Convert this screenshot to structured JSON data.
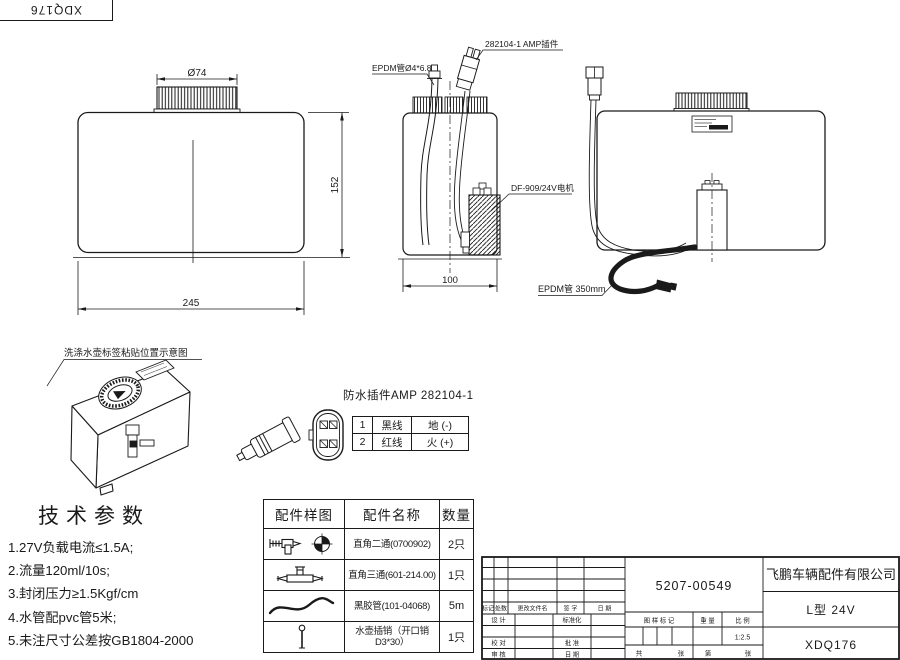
{
  "corner_stamp": {
    "code": "XDQ176"
  },
  "views": {
    "front": {
      "dims": {
        "cap_diameter": "Ø74",
        "height": "152",
        "width": "245"
      }
    },
    "side": {
      "dim_depth": "100",
      "callouts": {
        "tube": "EPDM管Ø4*6.8",
        "connector": "282104-1  AMP插件",
        "motor": "DF-909/24V电机"
      }
    },
    "right": {
      "callout_tube": "EPDM管 350mm"
    },
    "iso": {
      "caption": "洗涤水壶标签粘贴位置示意图"
    }
  },
  "connector_detail": {
    "title": "防水插件AMP 282104-1",
    "pins": [
      {
        "no": "1",
        "wire": "黑线",
        "function": "地 (-)"
      },
      {
        "no": "2",
        "wire": "红线",
        "function": "火 (+)"
      }
    ]
  },
  "tech_params": {
    "title": "技术参数",
    "items": [
      "1.27V负载电流≤1.5A;",
      "2.流量120ml/10s;",
      "3.封闭压力≥1.5Kgf/cm",
      "4.水管配pvc管5米;",
      "5.未注尺寸公差按GB1804-2000"
    ]
  },
  "parts_table": {
    "headers": [
      "配件样图",
      "配件名称",
      "数量"
    ],
    "rows": [
      {
        "icon": "elbow-fitting",
        "name": "直角二通(0700902)",
        "qty": "2只"
      },
      {
        "icon": "tee-fitting",
        "name": "直角三通(601-214.00)",
        "qty": "1只"
      },
      {
        "icon": "rubber-tube",
        "name": "黑胶管(101-04068)",
        "qty": "5m"
      },
      {
        "icon": "kettle-pin",
        "name": "水壶插销（开口销D3*30）",
        "qty": "1只"
      }
    ]
  },
  "title_block": {
    "part_number": "5207-00549",
    "company": "飞鹏车辆配件有限公司",
    "model": "L型 24V",
    "drawing_number": "XDQ176",
    "scale_value": "1:2.5",
    "labels": {
      "mark": "标记",
      "count": "处数",
      "changed_file": "更改文件名",
      "signature": "签 字",
      "date": "日 期",
      "design": "设 计",
      "standardization": "标准化",
      "check": "校 对",
      "approve": "批 准",
      "review": "审 核",
      "date2": "日 期",
      "drawing_mark": "图 样 标 记",
      "weight": "重 量",
      "scale": "比 例",
      "total": "共",
      "sheets": "张",
      "no": "第",
      "sheet": "张"
    }
  }
}
